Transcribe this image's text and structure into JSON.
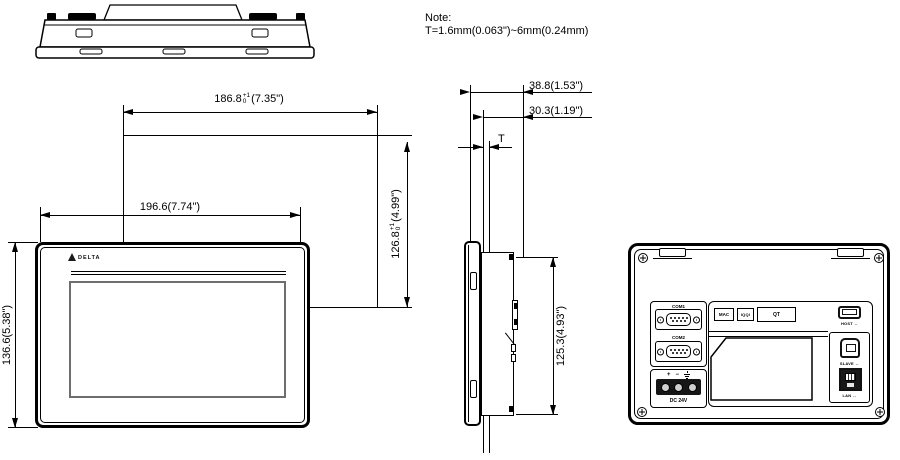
{
  "note": {
    "title": "Note:",
    "body": "T=1.6mm(0.063\")~6mm(0.24mm)"
  },
  "front": {
    "brand": "DELTA",
    "dim_cutout_width": {
      "value": "186.8",
      "tol_plus": "+1",
      "tol_minus": "0",
      "inches": "(7.35\")"
    },
    "dim_outer_width": "196.6(7.74\")",
    "dim_outer_height": "136.6(5.38\")",
    "dim_cutout_height": {
      "value": "126.8",
      "tol_plus": "+1",
      "tol_minus": "0",
      "inches": "(4.99\")"
    }
  },
  "side": {
    "dim_total_depth": "38.8(1.53\")",
    "dim_mount_depth": "30.3(1.19\")",
    "dim_panel_thickness": "T",
    "dim_body_height": "125.3(4.93\")"
  },
  "rear": {
    "com1": "COM1",
    "com2": "COM2",
    "sticker_mac": "MAC",
    "sticker_iqqi": "IQQI",
    "sticker_qt": "QT",
    "usb_host": {
      "label": "HOST",
      "icon": "↔"
    },
    "usb_slave": {
      "label": "SLAVE",
      "icon": "↔"
    },
    "lan": {
      "label": "LAN",
      "icon": "↔"
    },
    "power": {
      "plus": "+",
      "minus": "−",
      "dc": "DC 24V"
    }
  }
}
